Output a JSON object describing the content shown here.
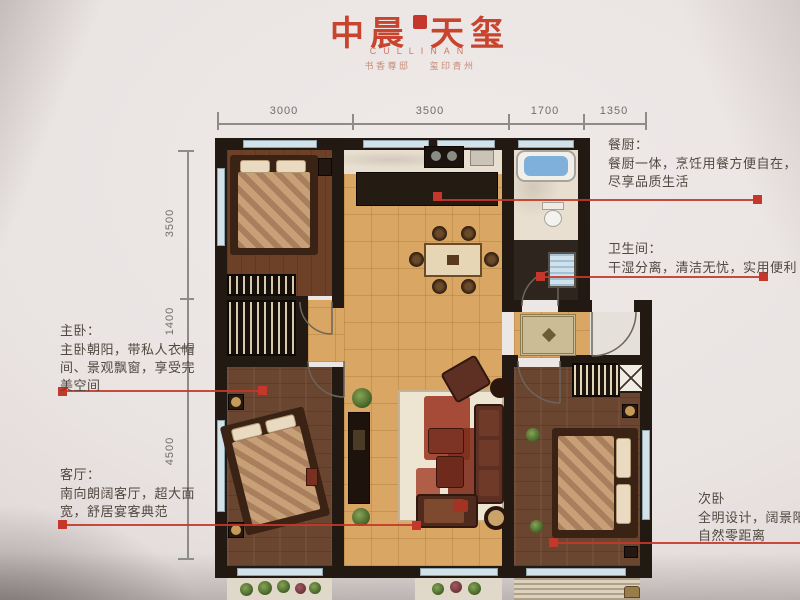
{
  "header": {
    "title_part1": "中晨",
    "title_part2": "天玺",
    "subtitle": "CULLINAN",
    "tagline": "书香尊邸 玺印青州"
  },
  "dimensions": {
    "top": [
      "3000",
      "3500",
      "1700",
      "1350"
    ],
    "left": [
      "3500",
      "1400",
      "4500"
    ]
  },
  "annotations": {
    "kitchen": {
      "title": "餐厨：",
      "line1": "餐厨一体，烹饪用餐方便自在，",
      "line2": "尽享品质生活"
    },
    "bathroom": {
      "title": "卫生间：",
      "line1": "干湿分离，清洁无忧，实用便利"
    },
    "master": {
      "title": "主卧：",
      "line1": "主卧朝阳，带私人衣帽",
      "line2": "间、景观飘窗，享受完",
      "line3": "美空间"
    },
    "living": {
      "title": "客厅：",
      "line1": "南向朗阔客厅，超大面",
      "line2": "宽，舒居宴客典范"
    },
    "second": {
      "title": "次卧",
      "line1": "全明设计，阔景阳台",
      "line2": "自然零距离"
    }
  },
  "colors": {
    "accent_red": "#c5372a",
    "title_red": "#c8442e",
    "wall": "#221a12",
    "wood_floor": "#6a4530",
    "tile_floor": "#d9a763"
  }
}
